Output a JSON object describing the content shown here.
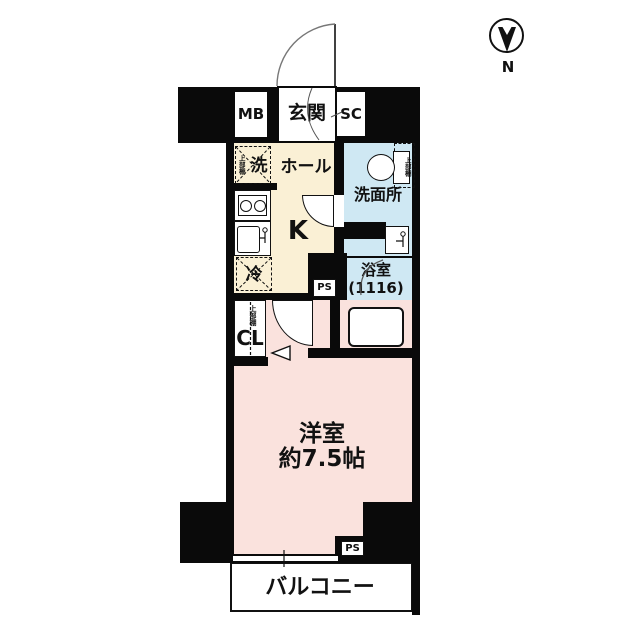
{
  "title": "floor-plan",
  "compass": {
    "label": "N"
  },
  "labels": {
    "entrance": "玄関",
    "meter_box": "MB",
    "shoe_closet": "SC",
    "hall": "ホール",
    "kitchen": "K",
    "washer": "洗",
    "fridge": "冷",
    "washroom": "洗面所",
    "bathroom": "浴室",
    "bathroom_size": "(1116)",
    "closet": "CL",
    "shelf": "上部棚",
    "main_room": "洋室",
    "main_room_size": "約7.5帖",
    "balcony": "バルコニー",
    "ps": "PS"
  },
  "colors": {
    "hall_floor": "#FAF0D5",
    "wet_area_floor": "#CFE8F3",
    "main_room_floor": "#FAE2DD",
    "wall": "#0a0a0a",
    "text": "#111111"
  }
}
